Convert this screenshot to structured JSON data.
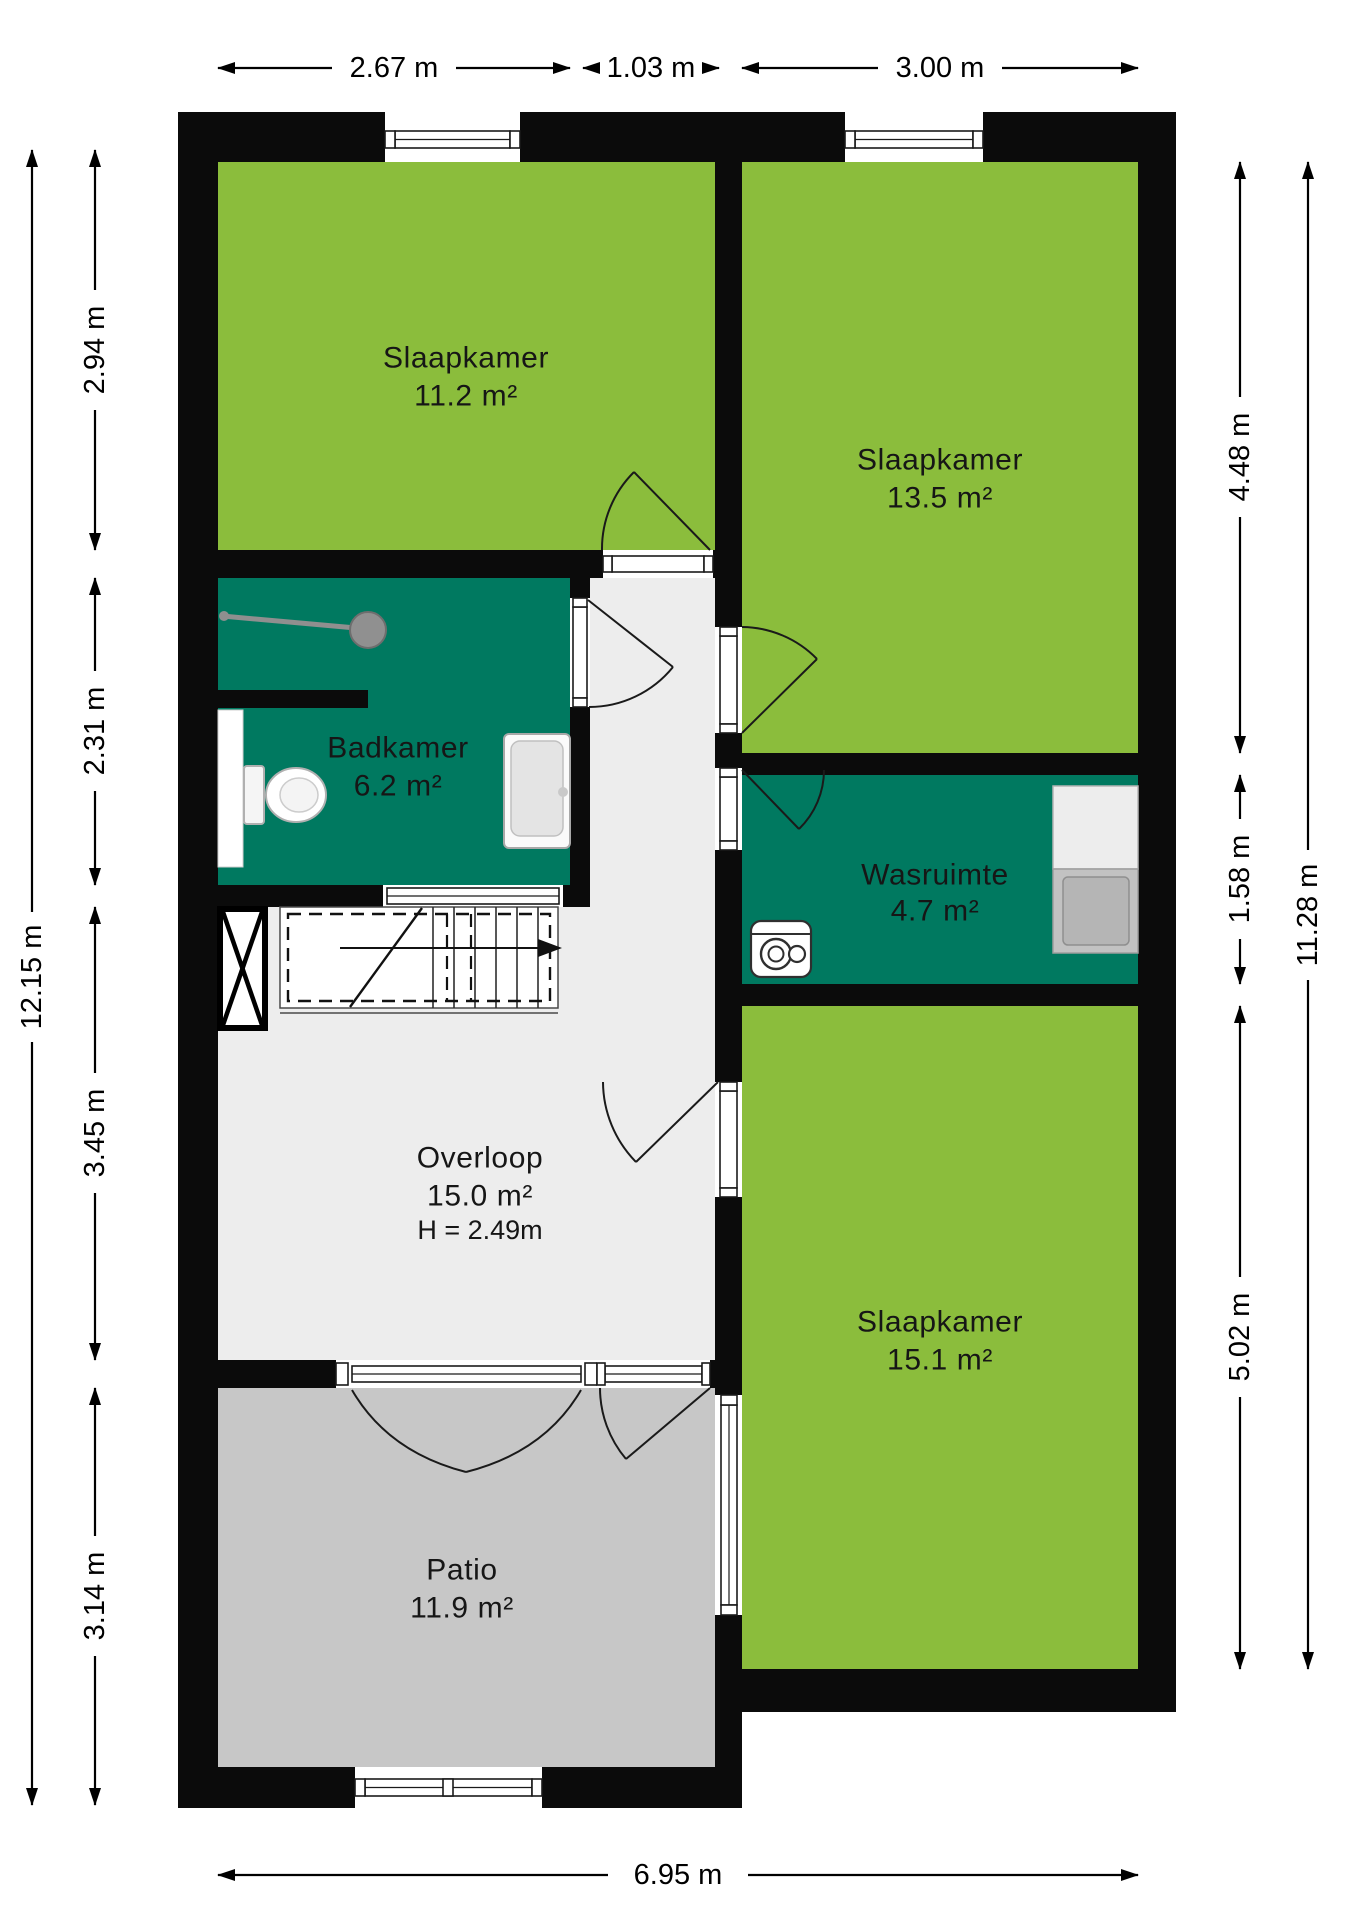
{
  "rooms": [
    {
      "name": "Slaapkamer",
      "area": "11.2 m²"
    },
    {
      "name": "Slaapkamer",
      "area": "13.5 m²"
    },
    {
      "name": "Badkamer",
      "area": "6.2 m²"
    },
    {
      "name": "Wasruimte",
      "area": "4.7 m²"
    },
    {
      "name": "Overloop",
      "area": "15.0 m²",
      "ceiling_height": "H = 2.49m"
    },
    {
      "name": "Slaapkamer",
      "area": "15.1 m²"
    },
    {
      "name": "Patio",
      "area": "11.9 m²"
    }
  ],
  "dimensions": {
    "top": [
      "2.67 m",
      "1.03 m",
      "3.00 m"
    ],
    "left_segments": [
      "2.94 m",
      "2.31 m",
      "3.45 m",
      "3.14 m"
    ],
    "left_total": "12.15 m",
    "right_segments": [
      "4.48 m",
      "1.58 m",
      "5.02 m"
    ],
    "right_total": "11.28 m",
    "bottom": "6.95 m"
  },
  "colors": {
    "room_green": "#8BBD3C",
    "room_teal": "#007960",
    "hall_floor": "#EDEDED",
    "patio_floor": "#C7C7C7",
    "wall": "#0B0B0B",
    "fixture_gray": "#909090",
    "appliance_gray": "#C2C2C2"
  },
  "icons": [
    "shower-icon",
    "toilet-icon",
    "bathtub-icon",
    "stairs-icon",
    "stair-direction-arrow-icon",
    "void-cross-icon",
    "boiler-icon",
    "dryer-icon",
    "washing-machine-icon",
    "window-symbol",
    "door-swing-symbol"
  ]
}
